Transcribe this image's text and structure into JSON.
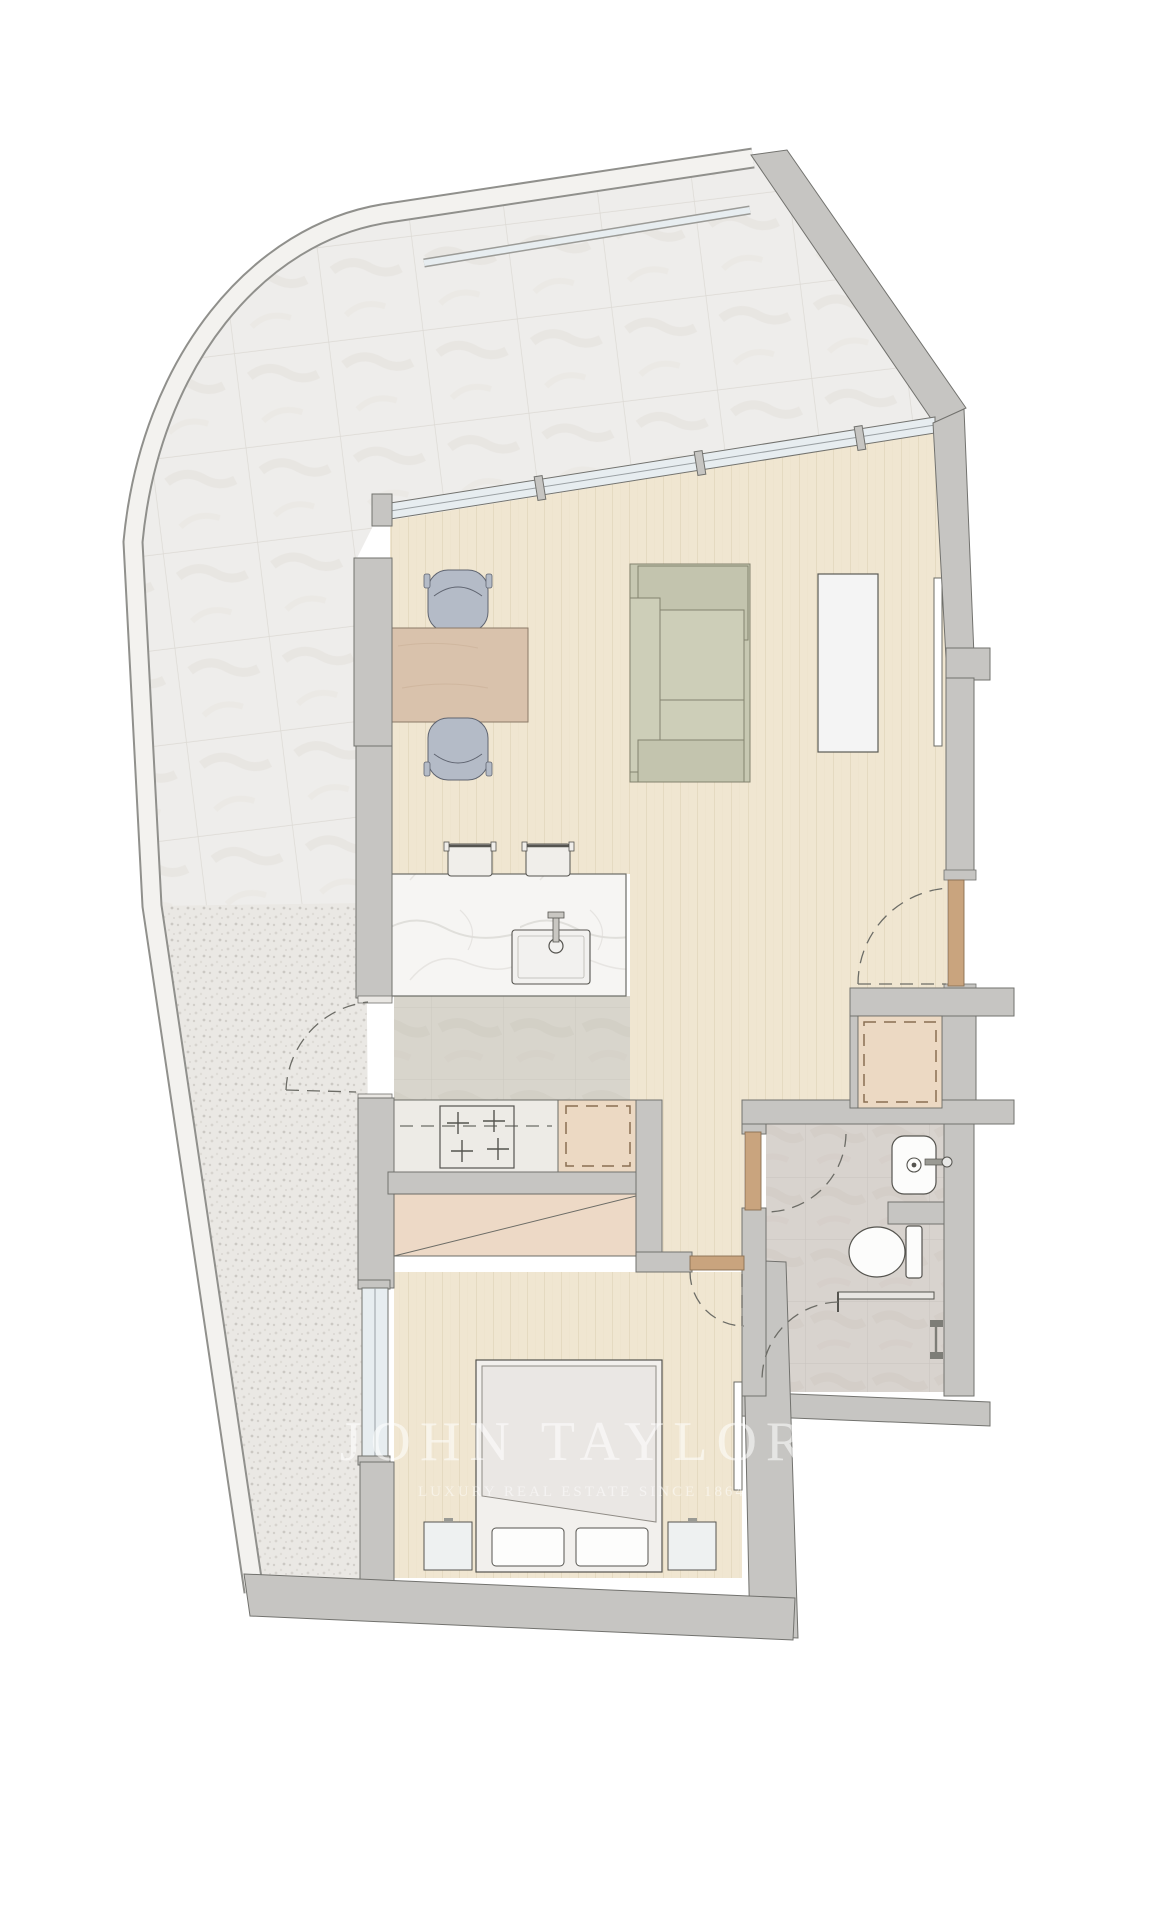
{
  "document": {
    "kind": "real-estate floor plan",
    "rooms_depicted": [
      "terrace",
      "living-dining-room",
      "kitchen",
      "entry-hall",
      "utility-closet",
      "bathroom",
      "bedroom"
    ]
  },
  "watermark": {
    "line1": "JOHN TAYLOR",
    "line2": "LUXURY REAL ESTATE SINCE 1864"
  },
  "furniture_symbols": [
    "dining-table",
    "dining-chair",
    "bar-stool",
    "sofa",
    "tv-console",
    "kitchen-island",
    "kitchen-sink",
    "cooktop",
    "refrigerator",
    "washing-machine",
    "washbasin",
    "toilet",
    "shower",
    "shower-door-swing",
    "double-bed",
    "pillow",
    "nightstand",
    "wardrobe",
    "wall-mirror",
    "door-swing",
    "window",
    "glass-balustrade"
  ],
  "colors": {
    "wall": "#c6c5c2",
    "wallLine": "#72726e",
    "outline": "#6c6c66",
    "tile": "#eeedeb",
    "tileJoint": "#dcd9d4",
    "gravel": "#eae8e4",
    "wood": "#f0e6d1",
    "woodLine": "#ddcfb5",
    "stone": "#d8d5cc",
    "bathFloor": "#d8d3ce",
    "island": "#f6f5f3",
    "counter": "#edebe6",
    "glass": "#e7edf0",
    "tan": "#ecd9c3",
    "door": "#c9a47e",
    "doorEdge": "#8a6f52",
    "sofa": "#c7c8b2",
    "sofaDark": "#c3c4ae",
    "sofaLight": "#cdceb8",
    "table": "#d9c2ac",
    "tableEdge": "#8b7a68",
    "chair": "#b4bbc7",
    "chairEdge": "#5f6470",
    "stool": "#f0eeea",
    "fixture": "#fcfcfb",
    "fixtureLine": "#55544f",
    "bedFrame": "#f2f0ed",
    "duvet": "#eae7e4",
    "duvetLine": "#8f8b85",
    "wardrobe": "#edd9c6",
    "parapet": "#f3f2ef",
    "parapetEdge": "#90908c",
    "watermark": "rgba(255,255,255,0.55)"
  }
}
